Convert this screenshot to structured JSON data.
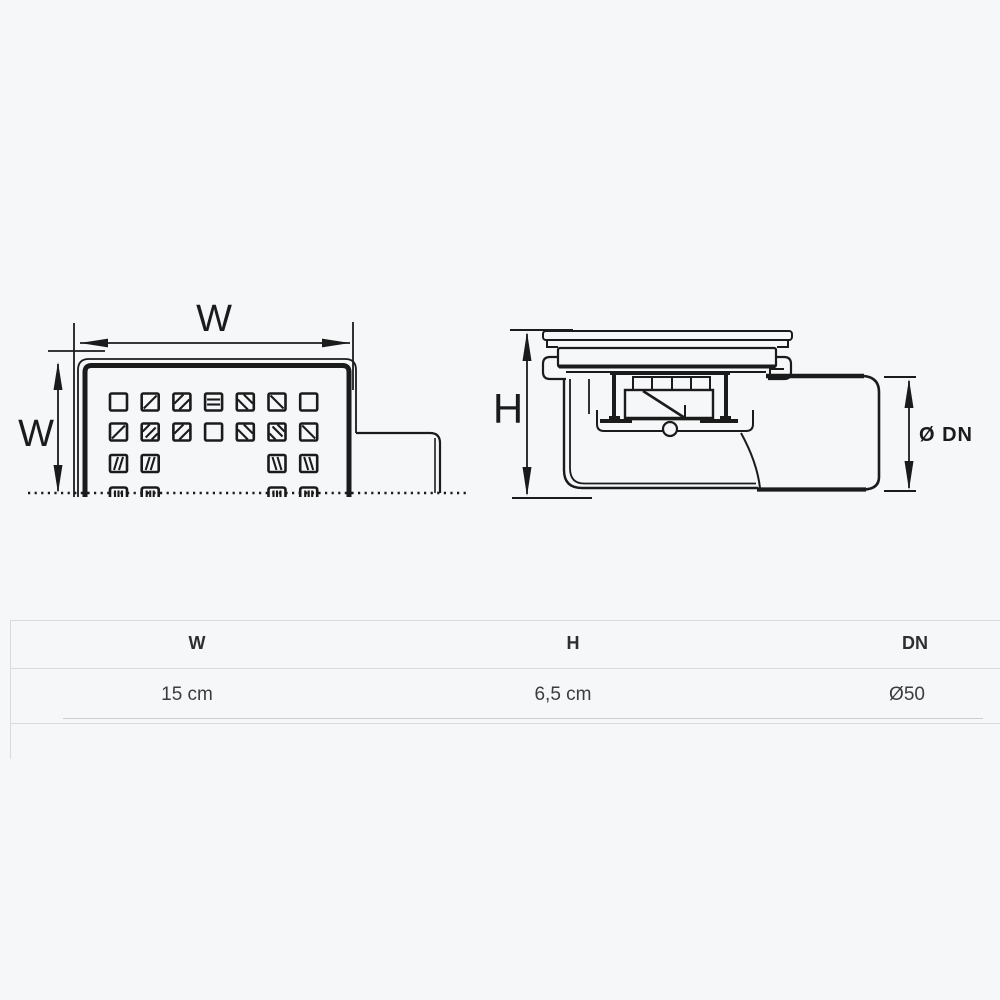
{
  "colors": {
    "background": "#f6f7f9",
    "drawing_line": "#1b1b1b",
    "table_border": "#d9dbde",
    "table_inner_line": "#c9ccd0",
    "header_text": "#2d2f31",
    "value_text": "#3b3d40"
  },
  "diagram": {
    "top_view": {
      "horizontal_dim_label": "W",
      "vertical_dim_label": "W"
    },
    "side_view": {
      "height_dim_label": "H",
      "diameter_dim_label": "Ø DN"
    }
  },
  "spec_table": {
    "headers": {
      "w": "W",
      "h": "H",
      "dn": "DN"
    },
    "row": {
      "w": "15 cm",
      "h": "6,5 cm",
      "dn": "Ø50"
    }
  }
}
